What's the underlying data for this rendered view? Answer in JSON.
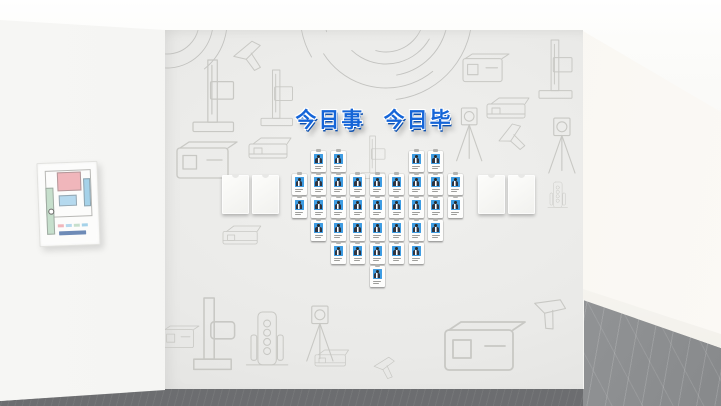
{
  "wall": {
    "title": "今日事 今日毕",
    "title_color": "#1565d8",
    "badge_grid": {
      "shape": "heart",
      "total_badges": 35,
      "columns": 9,
      "rows": [
        {
          "name": "row-1",
          "cols": [
            1,
            2,
            6,
            7
          ]
        },
        {
          "name": "row-2",
          "cols": [
            0,
            1,
            2,
            3,
            4,
            5,
            6,
            7,
            8
          ]
        },
        {
          "name": "row-3",
          "cols": [
            0,
            1,
            2,
            3,
            4,
            5,
            6,
            7,
            8
          ]
        },
        {
          "name": "row-4",
          "cols": [
            1,
            2,
            3,
            4,
            5,
            6,
            7
          ]
        },
        {
          "name": "row-5",
          "cols": [
            2,
            3,
            4,
            5,
            6
          ]
        },
        {
          "name": "row-6",
          "cols": [
            4
          ]
        }
      ],
      "photo_color": "#3e9ce2"
    },
    "blank_panel_count": 4
  },
  "poster": {
    "type": "evacuation-floor-plan",
    "colors": {
      "pink_room": "#f0b6bb",
      "blue_room_side": "#a5d2e9",
      "blue_room_center": "#b5d9ee",
      "green_corridor": "#c6dfcc",
      "caption": "#5577aa"
    }
  },
  "palette": {
    "main_wall": "#eaeae8",
    "left_wall": "#f2f2f0",
    "corridor_wall": "#f7f5f0",
    "front_floor": "#6c6d70",
    "marble_floor": "#8f9193",
    "sketch_line": "#c8c8c4"
  }
}
